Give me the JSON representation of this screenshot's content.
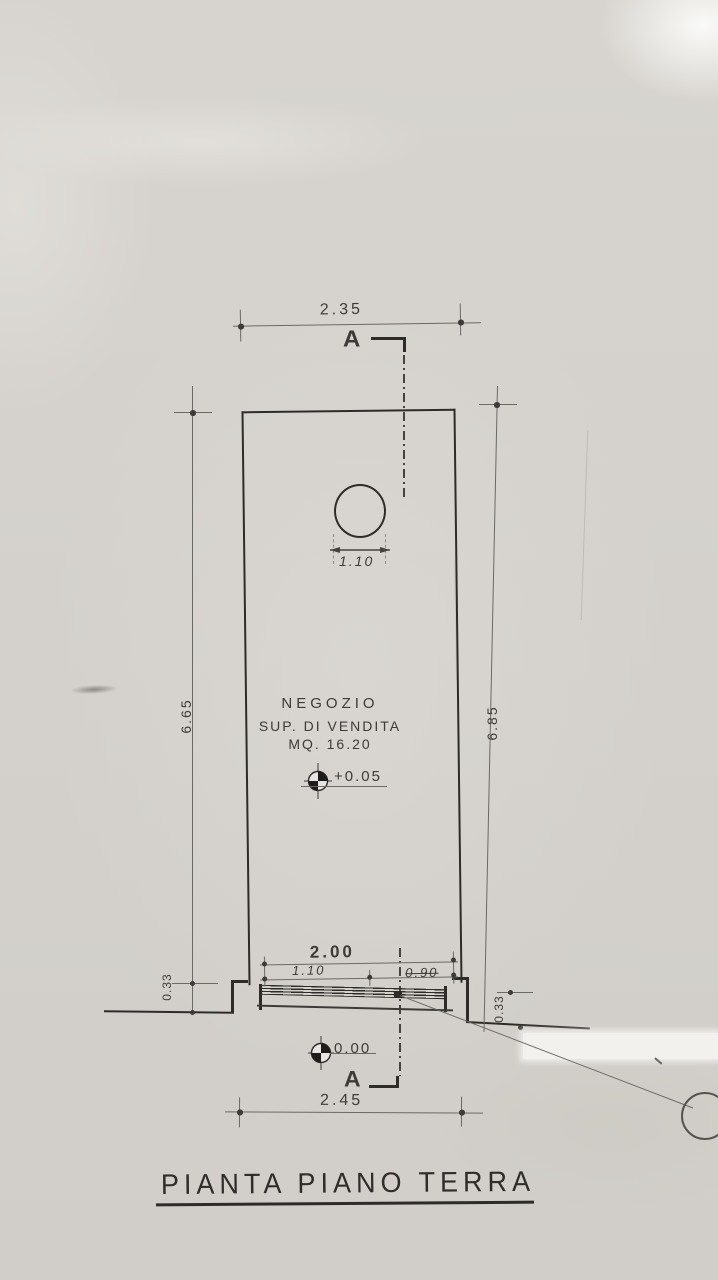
{
  "drawing": {
    "title": "PIANTA PIANO TERRA",
    "section": {
      "top_label": "A",
      "bottom_label": "A"
    },
    "room": {
      "name": "NEGOZIO",
      "line2": "SUP. DI VENDITA",
      "area": "MQ. 16.20"
    },
    "levels": {
      "interior": "+0.05",
      "exterior": "0.00"
    },
    "dims": {
      "top_width": "2.35",
      "circle_width": "1.10",
      "left_depth": "6.65",
      "right_depth": "6.85",
      "opening_total": "2.00",
      "opening_left": "1.10",
      "opening_right": "0.90",
      "curb_left": "0.33",
      "curb_right": "0.33",
      "bottom_width": "2.45"
    },
    "colors": {
      "ink": "#3d3b38",
      "paper": "#d6d3ce"
    }
  }
}
